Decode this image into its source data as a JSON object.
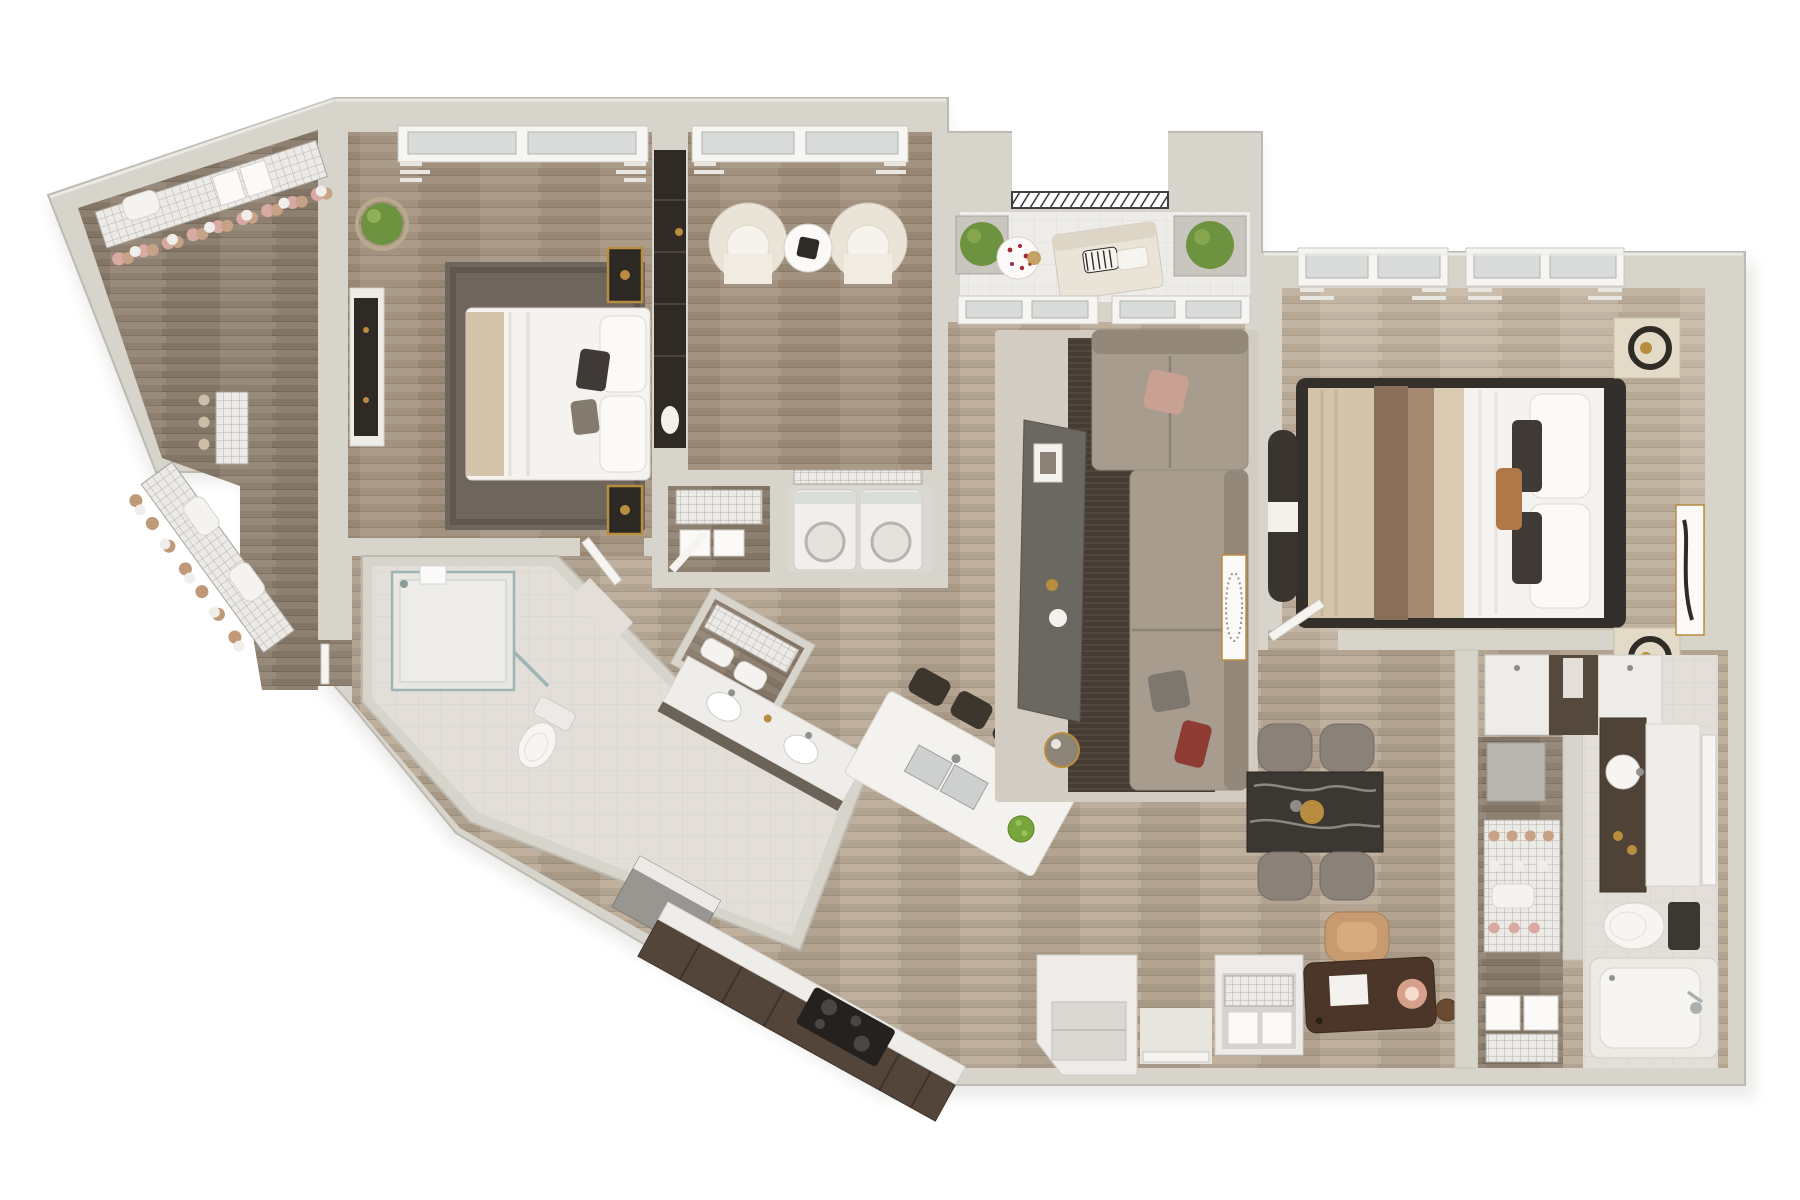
{
  "scene": {
    "kind": "3d-top-down-apartment-floor-plan-render",
    "background": "#ffffff",
    "counts": {
      "bedrooms": 2,
      "bathrooms": 2,
      "balconies": 1,
      "walk_in_closets": 2
    }
  },
  "palette": {
    "wall": "#d7d4cc",
    "wall_edge": "#bdbab2",
    "wall_shadow": "#aeaba3",
    "wood_main": "#b3a492",
    "wood_dark": "#a3927f",
    "wood_light": "#c2b4a2",
    "wood_closet": "#8e8071",
    "tile_bath": "#e3dfd8",
    "tile_balcony": "#edece8",
    "rug_dark": "#6e655d",
    "rug_brown": "#463c33",
    "rug_light": "#d2ccc2",
    "sofa": "#a79c8e",
    "sofa_back": "#93887a",
    "console_gray": "#6b6761",
    "chair_cream": "#eae4d8",
    "wardrobe_dark": "#2f2a26",
    "counter_cabinet": "#53453a",
    "countertop": "#efedea",
    "island": "#f4f2ee",
    "stool": "#3c362f",
    "marble_table": "#3b3733",
    "dining_chair": "#8a8178",
    "desk": "#4b3629",
    "chair_tan": "#c79a6f",
    "appliance": "#f1efeb",
    "fixture_white": "#f7f5f1",
    "glass": "#d8dbd9",
    "plant": "#6d9340",
    "gold": "#b98d3f",
    "bed_white": "#f5f3ef",
    "throw_tan": "#d4c5aa",
    "throw_brown": "#8a6f58",
    "bed_frame_dark": "#332f2b",
    "railing": "#3f3f3f",
    "cooktop": "#24211e"
  },
  "rooms": [
    {
      "id": "walk-in-closet-1",
      "furniture": [
        "wire-shelving",
        "hanging-clothes",
        "shoe-baskets",
        "storage-boxes",
        "pillows"
      ]
    },
    {
      "id": "bedroom-1",
      "furniture": [
        "double-bed",
        "area-rug",
        "wall-niche-sconces",
        "media-dresser",
        "potted-plant",
        "windows-with-curtains",
        "door"
      ]
    },
    {
      "id": "den",
      "furniture": [
        "barrel-chair",
        "barrel-chair",
        "round-side-table",
        "tall-dark-wardrobe",
        "window-with-curtains"
      ]
    },
    {
      "id": "storage-closet",
      "furniture": [
        "wire-drawer-unit",
        "storage-boxes",
        "door"
      ]
    },
    {
      "id": "laundry-closet",
      "furniture": [
        "washer",
        "dryer",
        "wire-shelf"
      ]
    },
    {
      "id": "hall-closet",
      "furniture": [
        "wire-shelving",
        "linens"
      ]
    },
    {
      "id": "bathroom-1",
      "furniture": [
        "glass-shower",
        "toilet",
        "double-sink-vanity"
      ]
    },
    {
      "id": "kitchen",
      "furniture": [
        "l-shaped-counter",
        "cooktop",
        "corner-appliance",
        "island-with-double-sink",
        "bar-stools",
        "fruit-bowl"
      ]
    },
    {
      "id": "living-room",
      "furniture": [
        "sectional-sofa",
        "angular-media-console",
        "layered-rugs",
        "round-side-table",
        "leaning-art",
        "windows"
      ]
    },
    {
      "id": "balcony",
      "furniture": [
        "open-railing",
        "planter-boxes",
        "loveseat",
        "round-table-with-flowers"
      ]
    },
    {
      "id": "bedroom-2",
      "furniture": [
        "king-bed",
        "nightstands",
        "round-mirror-decor",
        "foot-bench",
        "framed-art",
        "windows-with-curtains"
      ]
    },
    {
      "id": "walk-in-closet-2",
      "furniture": [
        "wire-shelving",
        "drawer-cubes",
        "shoe-baskets"
      ]
    },
    {
      "id": "bathroom-2",
      "furniture": [
        "vanity-with-round-sink",
        "wall-mirror",
        "toilet",
        "bathtub",
        "storage-cabinets"
      ]
    },
    {
      "id": "dining-area",
      "furniture": [
        "marble-dining-table",
        "dining-chairs",
        "gold-centerpiece"
      ]
    },
    {
      "id": "entry",
      "furniture": [
        "entry-door",
        "storage-closet",
        "storage-closet-with-baskets",
        "writing-desk",
        "desk-lamp",
        "tan-office-chair"
      ]
    }
  ]
}
